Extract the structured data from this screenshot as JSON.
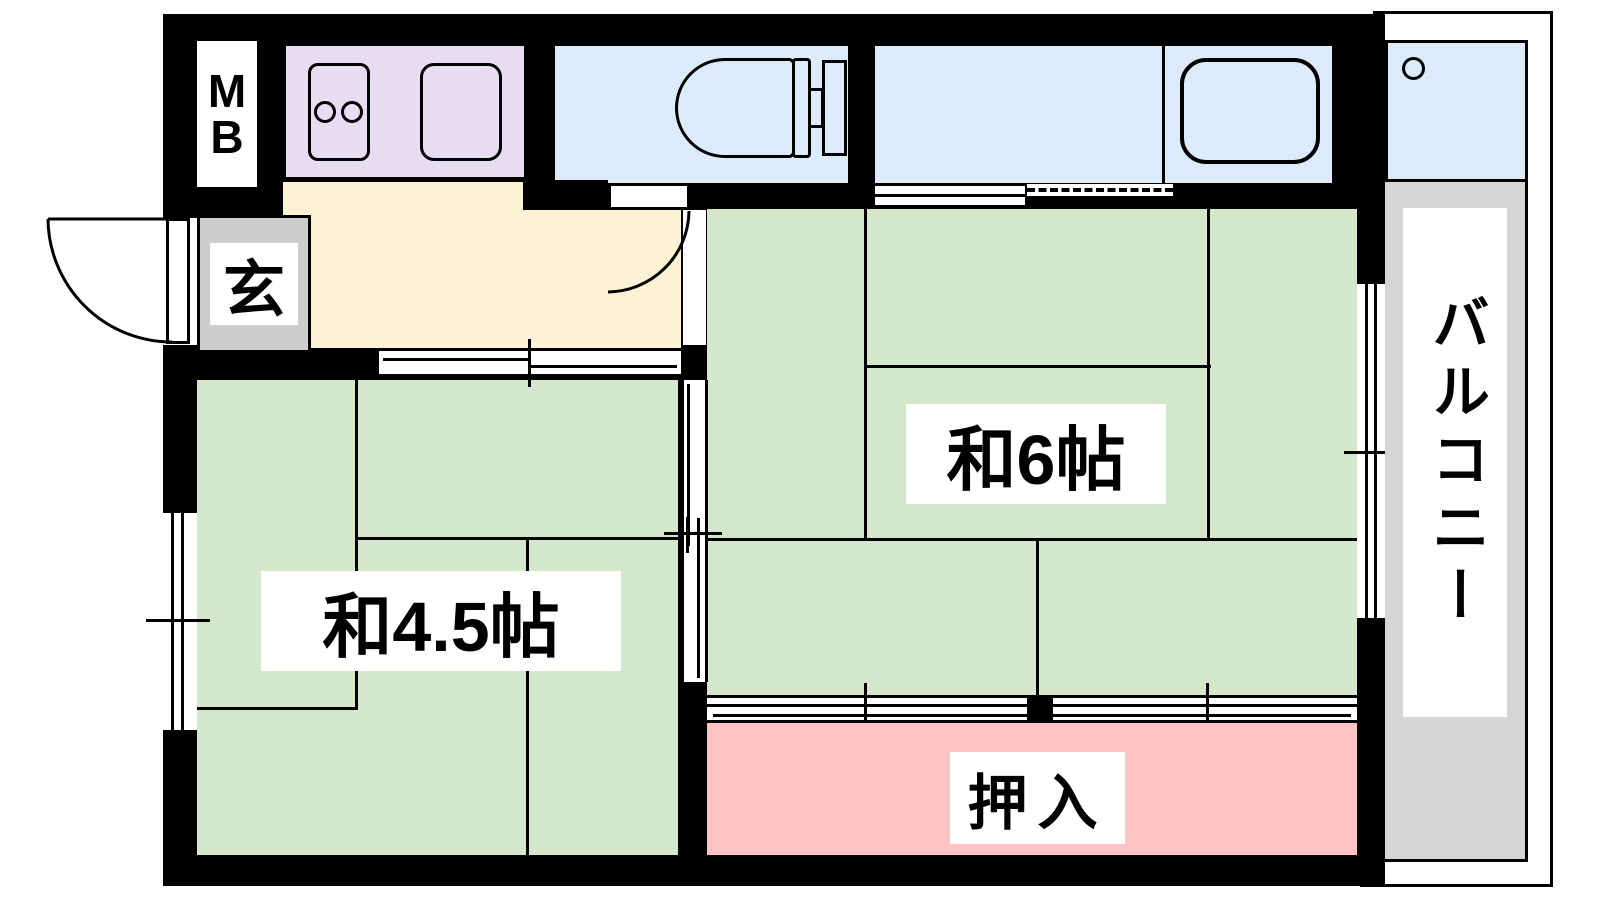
{
  "plan_type": "japanese-apartment-floor-plan",
  "labels": {
    "meter_box_m": "M",
    "meter_box_b": "B",
    "genkan": "玄",
    "washitsu_6": "和6帖",
    "washitsu_45": "和4.5帖",
    "oshiire": "押入",
    "balcony": "バルコニー"
  },
  "colors": {
    "tatami": "#d5e7cb",
    "water": "#dcebfa",
    "kitchen": "#e7dcf2",
    "hall": "#fdf2d3",
    "closet": "#ffc3c3",
    "genkan": "#cdcdcd",
    "balcony": "#d5d5d5",
    "wall": "#000000"
  },
  "icons": {
    "stove": "two-burner-stove-icon",
    "sink": "kitchen-sink-icon",
    "toilet": "toilet-icon",
    "bathtub": "bathtub-icon",
    "faucet": "balcony-faucet-circle-icon",
    "doors": "door-swing-arc-icon",
    "windows": "window-band-icon"
  }
}
